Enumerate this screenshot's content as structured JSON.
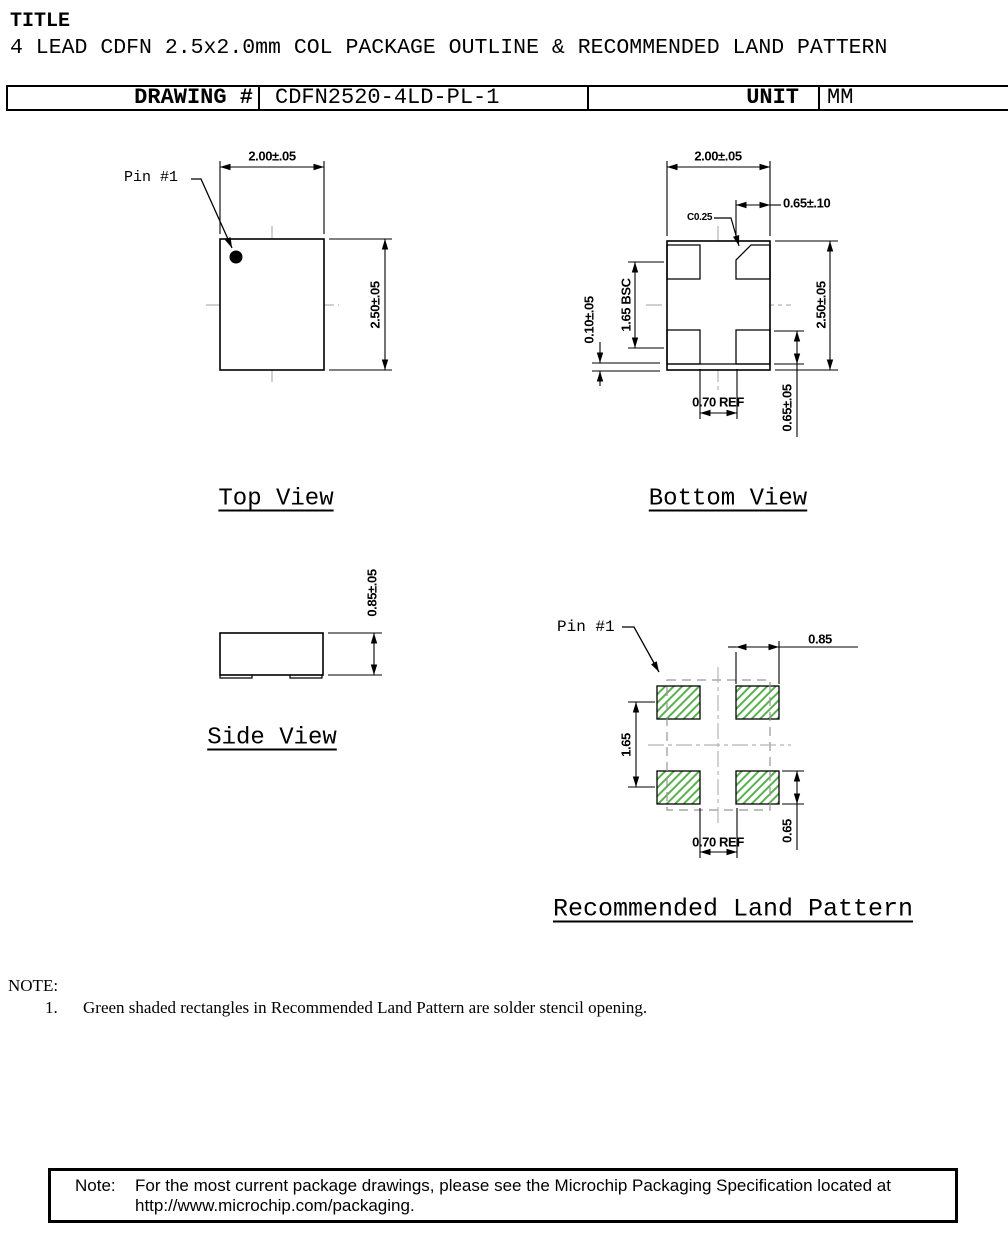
{
  "header": {
    "title_label": "TITLE",
    "title": "4 LEAD CDFN 2.5x2.0mm COL PACKAGE OUTLINE & RECOMMENDED LAND PATTERN",
    "drawing_label": "DRAWING #",
    "drawing_number": "CDFN2520-4LD-PL-1",
    "unit_label": "UNIT",
    "unit_value": "MM"
  },
  "views": {
    "top": {
      "title": "Top View",
      "pin1_label": "Pin #1",
      "dims": {
        "width": "2.00±.05",
        "height": "2.50±.05"
      }
    },
    "bottom": {
      "title": "Bottom View",
      "dims": {
        "width": "2.00±.05",
        "height": "2.50±.05",
        "pad_width": "0.65±.10",
        "chamfer": "C0.25",
        "pad_pitch": "1.65 BSC",
        "step": "0.10±.05",
        "pad_gap": "0.70 REF",
        "pad_height": "0.65±.05"
      }
    },
    "side": {
      "title": "Side View",
      "dims": {
        "height": "0.85±.05"
      }
    },
    "land": {
      "title": "Recommended Land Pattern",
      "pin1_label": "Pin #1",
      "dims": {
        "pad_width": "0.85",
        "pad_pitch": "1.65",
        "pad_gap": "0.70 REF",
        "pad_height": "0.65"
      }
    }
  },
  "notes": {
    "heading": "NOTE:",
    "item_number": "1.",
    "item_text": "Green shaded rectangles in Recommended Land Pattern are solder stencil opening."
  },
  "footer_note": {
    "label": "Note:",
    "line1": "For the most current package drawings, please see the Microchip Packaging Specification located at",
    "line2": "http://www.microchip.com/packaging."
  },
  "colors": {
    "stencil_green": "#57b14d",
    "centerline_gray": "#b5b5b5",
    "outline_dash_gray": "#979797"
  }
}
